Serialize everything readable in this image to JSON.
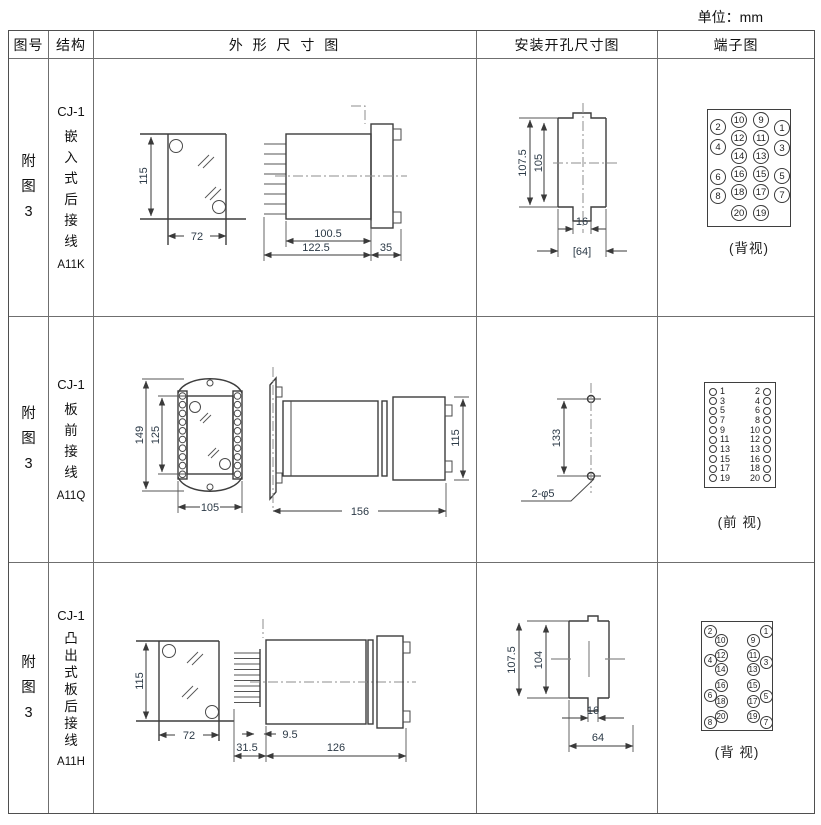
{
  "unit_label": "单位：mm",
  "header": {
    "fig": "图号",
    "structure": "结构",
    "outline": "外 形 尺 寸 图",
    "mounting": "安装开孔尺寸图",
    "terminal": "端子图"
  },
  "rows": [
    {
      "fig": "附\n图\n3",
      "model": "CJ-1",
      "structure": "嵌\n入\n式\n后\n接\n线",
      "code": "A11K",
      "outline": {
        "front_h": "115",
        "front_w": "72",
        "body_len": "100.5",
        "total_len": "122.5",
        "flange_len": "35"
      },
      "mounting": {
        "outer_h": "107.5",
        "inner_h": "105",
        "slot_w": "16",
        "cutout_w": "[64]"
      },
      "terminal": {
        "caption": "(背视)",
        "inner_left": [
          "10",
          "12",
          "14",
          "16",
          "18",
          "20"
        ],
        "inner_right": [
          "9",
          "11",
          "13",
          "15",
          "17",
          "19"
        ],
        "outer_left": [
          "2",
          "4",
          "6",
          "8"
        ],
        "outer_right": [
          "1",
          "3",
          "5",
          "7"
        ]
      }
    },
    {
      "fig": "附\n图\n3",
      "model": "CJ-1",
      "structure": "板\n前\n接\n线",
      "code": "A11Q",
      "outline": {
        "outer_h": "149",
        "inner_h": "125",
        "front_w": "105",
        "total_len": "156",
        "rear_h": "115"
      },
      "mounting": {
        "hole_dist": "133",
        "hole_label": "2-φ5"
      },
      "terminal": {
        "caption": "(前 视)",
        "left": [
          "1",
          "3",
          "5",
          "7",
          "9",
          "11",
          "13",
          "15",
          "17",
          "19"
        ],
        "right": [
          "2",
          "4",
          "6",
          "8",
          "10",
          "12",
          "13",
          "16",
          "18",
          "20"
        ]
      }
    },
    {
      "fig": "附\n图\n3",
      "model": "CJ-1",
      "structure": "凸\n出\n式\n板\n后\n接\n线",
      "code": "A11H",
      "outline": {
        "front_h": "115",
        "front_w": "72",
        "pins_len": "31.5",
        "gap_len": "9.5",
        "body_len": "126"
      },
      "mounting": {
        "outer_h": "107.5",
        "inner_h": "104",
        "slot_w": "16",
        "cutout_w": "64"
      },
      "terminal": {
        "caption": "(背 视)",
        "inner_left": [
          "10",
          "12",
          "14",
          "16",
          "18",
          "20"
        ],
        "inner_right": [
          "9",
          "11",
          "13",
          "15",
          "17",
          "19"
        ],
        "outer_left": [
          "2",
          "4",
          "6",
          "8"
        ],
        "outer_right": [
          "1",
          "3",
          "5",
          "7"
        ]
      }
    }
  ]
}
